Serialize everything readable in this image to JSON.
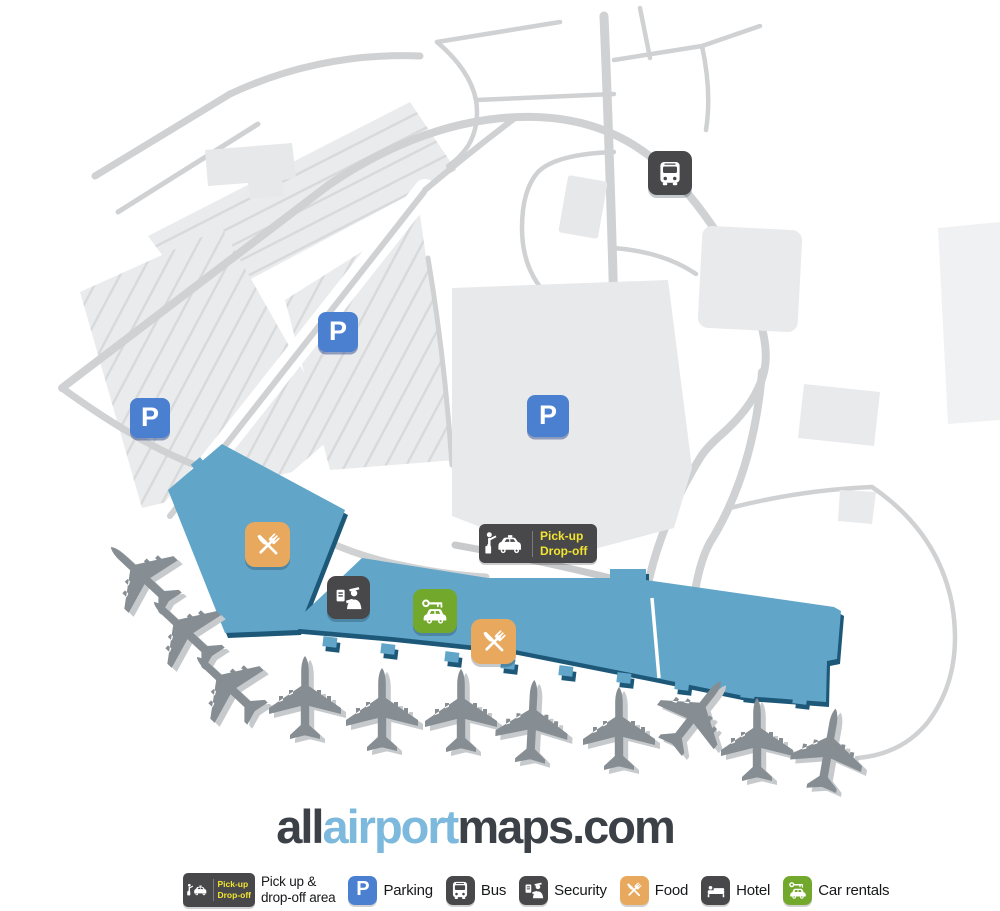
{
  "map": {
    "parking_badge_label": "P",
    "pickup_badge": {
      "line1": "Pick-up",
      "line2": "Drop-off"
    }
  },
  "logo": {
    "part_all": "all",
    "part_airport": "airport",
    "part_maps": "maps.com"
  },
  "legend": {
    "pickup_item": {
      "badge_line1": "Pick-up",
      "badge_line2": "Drop-off",
      "label_line1": "Pick up &",
      "label_line2": "drop-off area"
    },
    "items": [
      {
        "icon": "parking-icon",
        "letter": "P",
        "label": "Parking"
      },
      {
        "icon": "bus-icon",
        "label": "Bus"
      },
      {
        "icon": "security-icon",
        "label": "Security"
      },
      {
        "icon": "food-icon",
        "label": "Food"
      },
      {
        "icon": "hotel-icon",
        "label": "Hotel"
      },
      {
        "icon": "car-rentals-icon",
        "label": "Car rentals"
      }
    ]
  },
  "colors": {
    "terminal": "#61a5c9",
    "terminal_edge": "#1d5878",
    "road": "#d0d1d3",
    "parking_fill": "#eaebed",
    "plane": "#868d93",
    "marker_blue": "#4b80d1",
    "marker_dark": "#48484a",
    "marker_orange": "#e8a95e",
    "marker_green": "#72a82b",
    "pickup_text": "#f2e432",
    "logo_dark": "#3b4147",
    "logo_blue": "#7db9dd"
  }
}
